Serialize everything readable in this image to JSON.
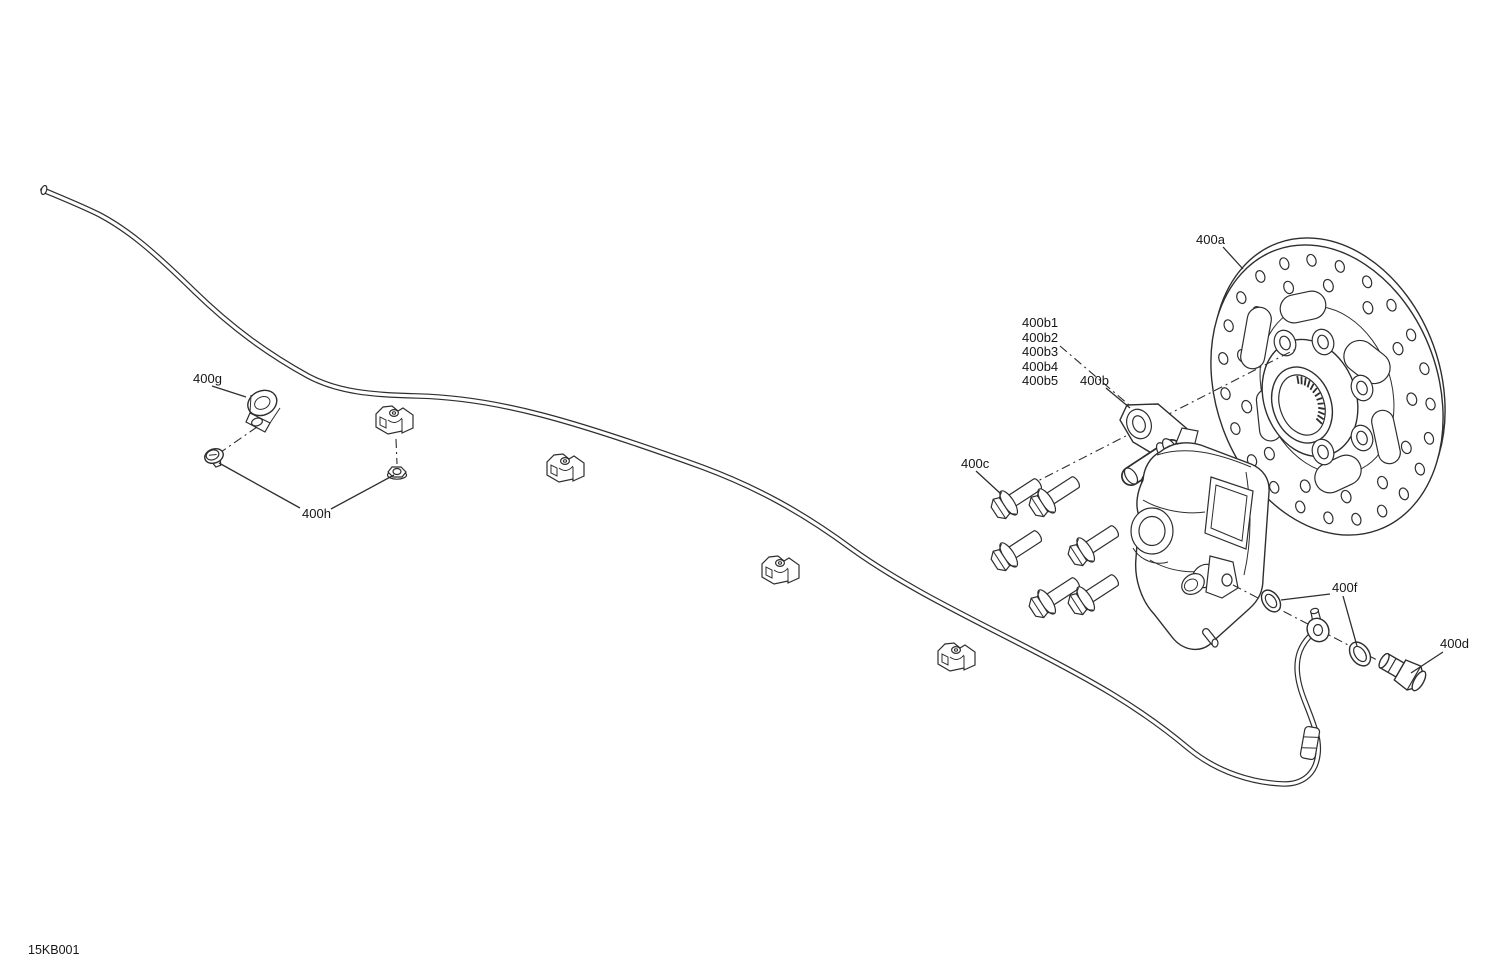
{
  "theme": {
    "background": "#ffffff",
    "line_color": "#2e2e2e",
    "label_color": "#161616"
  },
  "drawing": {
    "code": "15KB001"
  },
  "callouts": {
    "c400a": "400a",
    "c400b1": "400b1",
    "c400b2": "400b2",
    "c400b3": "400b3",
    "c400b4": "400b4",
    "c400b5": "400b5",
    "c400b": "400b",
    "c400c": "400c",
    "c400d": "400d",
    "c400f": "400f",
    "c400g": "400g",
    "c400h": "400h"
  },
  "parts": {
    "brake_disc_callout": "400a",
    "caliper_adapter_callout": "400b",
    "caliper_kit_callouts": [
      "400b1",
      "400b2",
      "400b3",
      "400b4",
      "400b5"
    ],
    "mounting_bolts": {
      "callout": "400c",
      "count": 6
    },
    "banjo_bolt_callout": "400d",
    "sealing_washers": {
      "callout": "400f",
      "count": 2
    },
    "hose_clamp_callout": "400g",
    "clamp_fasteners": {
      "callout": "400h",
      "count": 2
    },
    "hose_clips_count": 4
  }
}
